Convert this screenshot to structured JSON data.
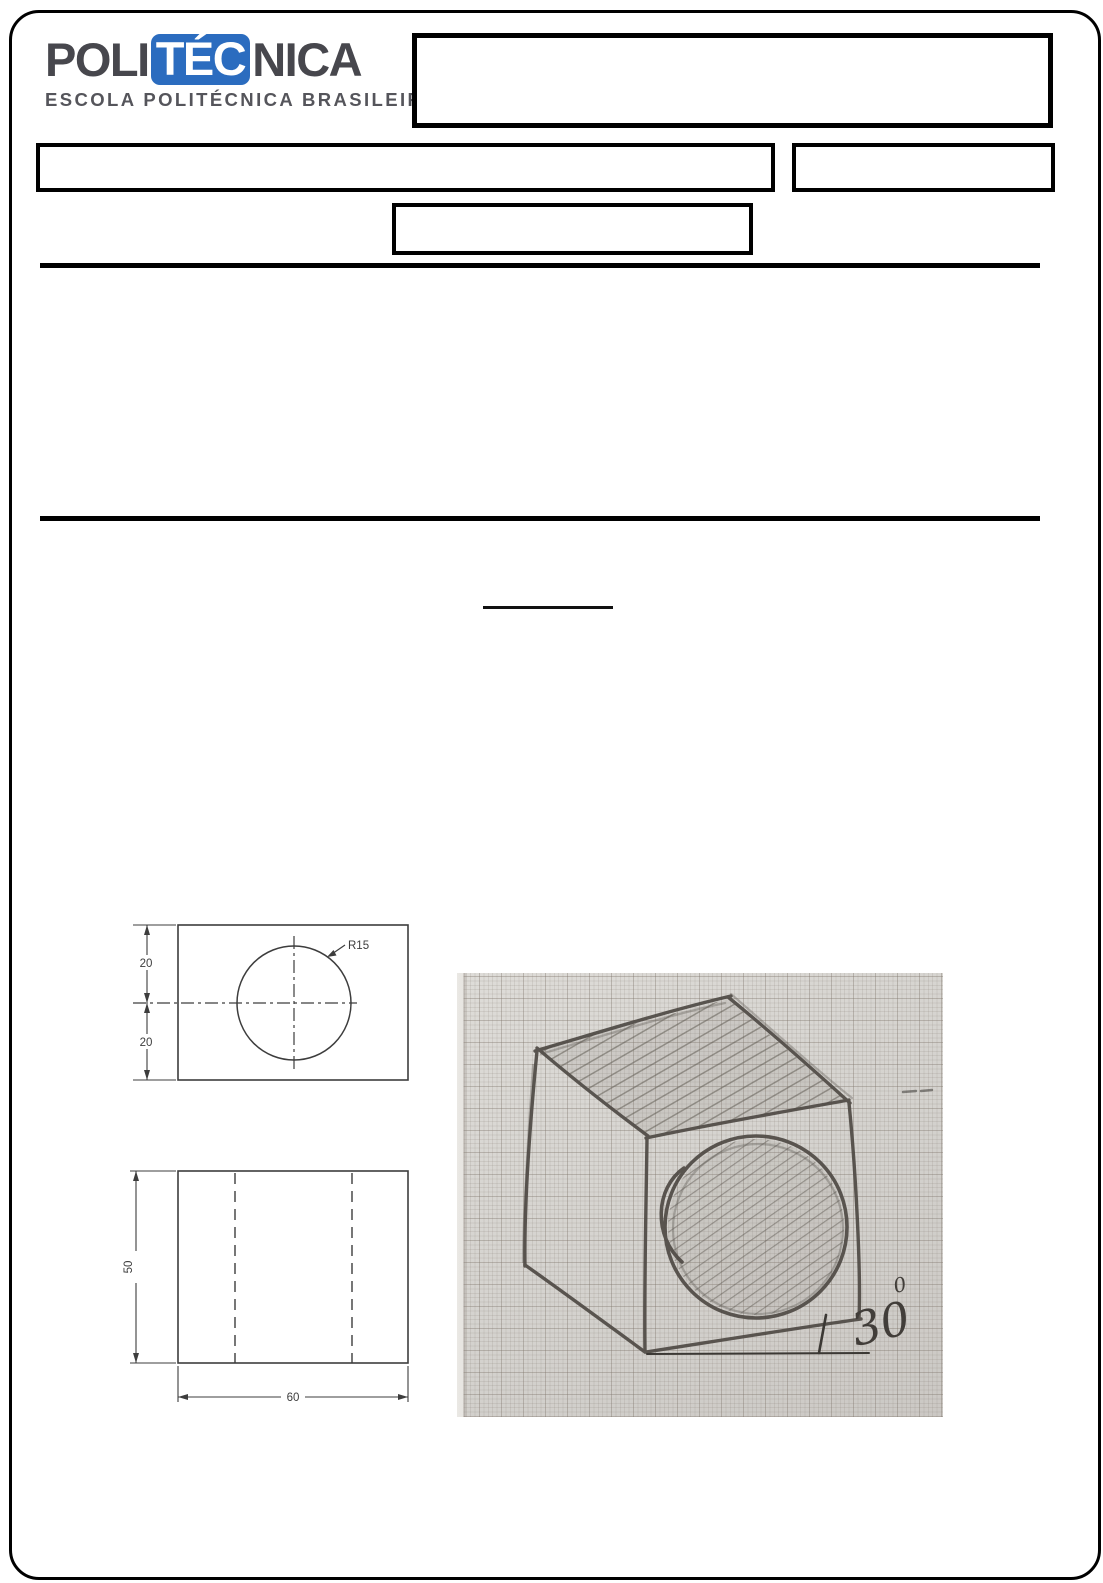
{
  "page": {
    "background": "#ffffff",
    "border_color": "#000000"
  },
  "header": {
    "logo": {
      "word_part1": "POLI",
      "word_part2": "TÉC",
      "word_part3": "NICA",
      "subtitle": "ESCOLA POLITÉCNICA BRASILEIRA",
      "accent_color": "#2b6cbf",
      "text_color": "#47474d"
    }
  },
  "technical_drawing": {
    "line_color": "#3d3d3d",
    "top_view": {
      "dim_upper": "20",
      "dim_lower": "20",
      "radius_label": "R15"
    },
    "front_view": {
      "dim_height": "50",
      "dim_width": "60"
    }
  },
  "sketch_photo": {
    "angle_value": "30",
    "angle_degree": "0",
    "pencil_color": "#4f4a45"
  }
}
